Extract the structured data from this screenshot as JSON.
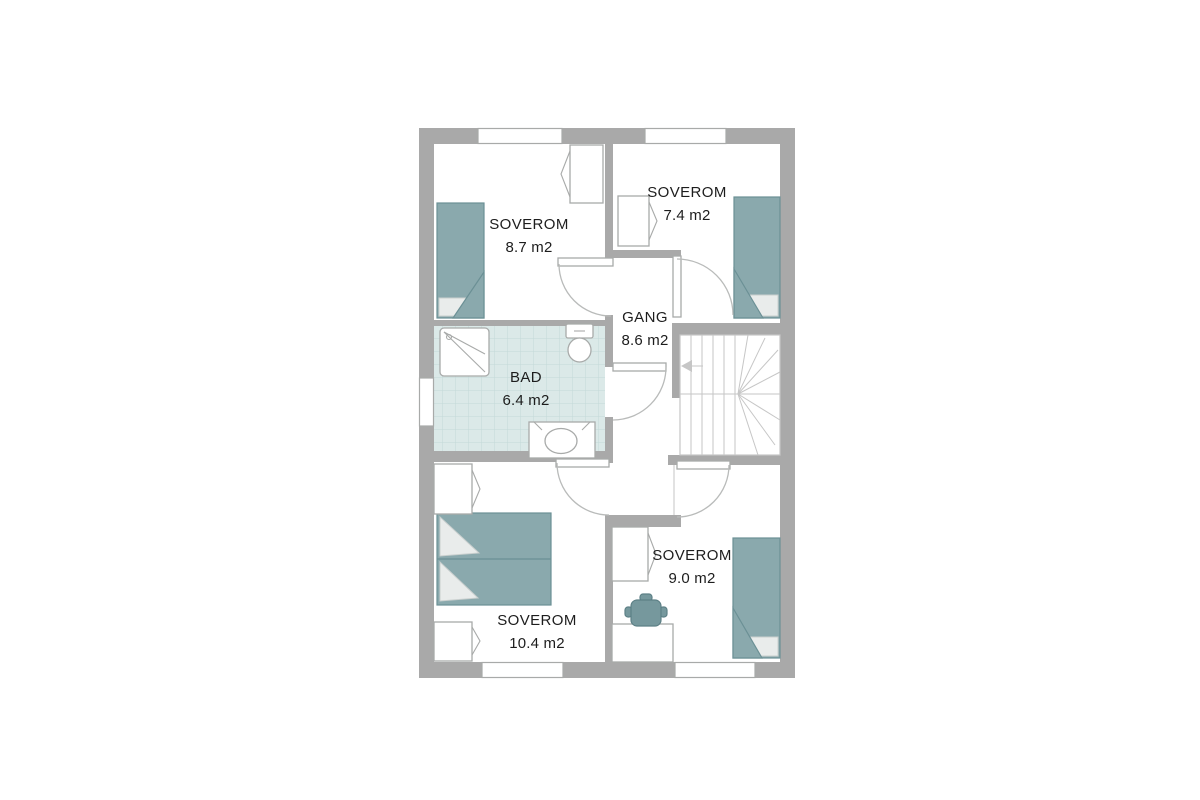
{
  "title": "Floor plan – upper storey",
  "rooms": [
    {
      "id": "soverom-nw",
      "name": "SOVEROM",
      "area": "8.7 m2"
    },
    {
      "id": "soverom-ne",
      "name": "SOVEROM",
      "area": "7.4 m2"
    },
    {
      "id": "gang",
      "name": "GANG",
      "area": "8.6 m2"
    },
    {
      "id": "bad",
      "name": "BAD",
      "area": "6.4 m2"
    },
    {
      "id": "soverom-sw",
      "name": "SOVEROM",
      "area": "10.4 m2"
    },
    {
      "id": "soverom-se",
      "name": "SOVEROM",
      "area": "9.0 m2"
    }
  ],
  "fixtures": [
    "single-bed",
    "single-bed",
    "single-bed",
    "double-bed",
    "wardrobe",
    "wardrobe",
    "wardrobe",
    "wardrobe",
    "wardrobe",
    "shower",
    "toilet",
    "sink-vanity",
    "staircase",
    "desk",
    "pot"
  ],
  "colors": {
    "wall": "#a9a9a9",
    "line": "#a8aaa9",
    "stair_line": "#c6c6c6",
    "teal": "#8aa9ad",
    "teal_dark": "#6b9095",
    "pillow": "#e9eceb",
    "pillow_border": "#c9cfce",
    "tile": "#dbe9e8",
    "tile_grid": "#c3d9d8",
    "pot": "#76989d",
    "pot_dark": "#5d8086",
    "text": "#1d1d1d",
    "bg": "#ffffff"
  }
}
